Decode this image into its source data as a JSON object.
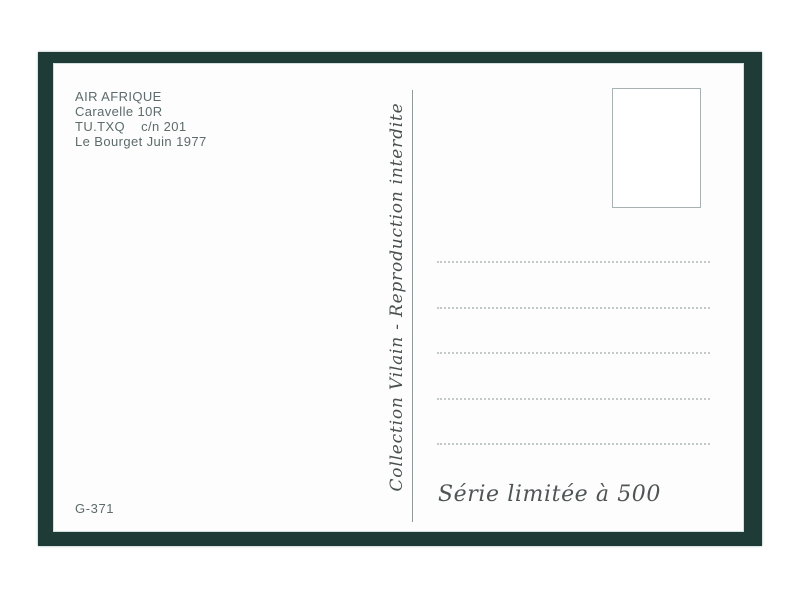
{
  "postcard": {
    "caption": {
      "lines": [
        "AIR AFRIQUE",
        "Caravelle 10R",
        "TU.TXQ    c/n 201",
        "Le Bourget Juin 1977"
      ]
    },
    "collection_credit": "Collection Vilain - Reproduction interdite",
    "series_note": "Série limitée à 500",
    "reference_number": "G-371",
    "address_lines": {
      "count": 5
    },
    "colors": {
      "frame_green": "#1e3b37",
      "caption_text": "#5d6b6b",
      "script_text": "#4a4f4f",
      "divider_line": "#8f9a9a",
      "dotted_line": "#c3c9c9",
      "stamp_box_border": "#a8b2b2",
      "card_background": "#fdfdfd",
      "page_background": "#ffffff"
    }
  }
}
